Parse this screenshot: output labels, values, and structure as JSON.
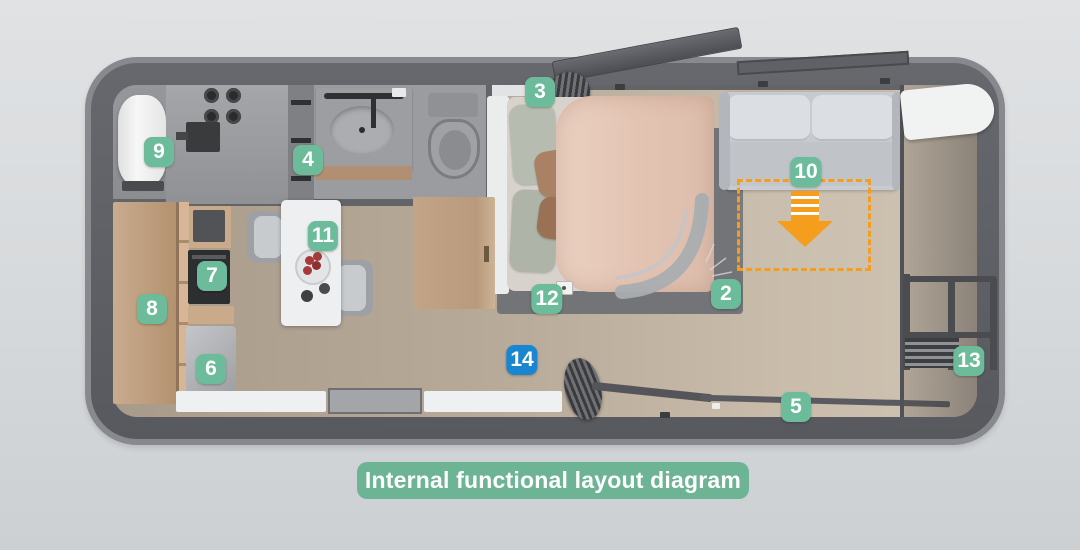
{
  "caption": {
    "text": "Internal functional layout diagram"
  },
  "colors": {
    "badge_green": "#6cbc9b",
    "badge_blue": "#1b86d0",
    "arrow_orange": "#f59d1d",
    "caption_bg": "#6db495",
    "caption_text": "#ffffff"
  },
  "badges": [
    {
      "label": "2",
      "x": 726,
      "y": 294,
      "color": "green"
    },
    {
      "label": "3",
      "x": 540,
      "y": 92,
      "color": "green"
    },
    {
      "label": "4",
      "x": 308,
      "y": 160,
      "color": "green"
    },
    {
      "label": "5",
      "x": 796,
      "y": 407,
      "color": "green"
    },
    {
      "label": "6",
      "x": 211,
      "y": 369,
      "color": "green"
    },
    {
      "label": "7",
      "x": 212,
      "y": 276,
      "color": "green"
    },
    {
      "label": "8",
      "x": 152,
      "y": 309,
      "color": "green"
    },
    {
      "label": "9",
      "x": 159,
      "y": 152,
      "color": "green"
    },
    {
      "label": "10",
      "x": 806,
      "y": 172,
      "color": "green"
    },
    {
      "label": "11",
      "x": 323,
      "y": 236,
      "color": "green"
    },
    {
      "label": "12",
      "x": 547,
      "y": 299,
      "color": "green"
    },
    {
      "label": "13",
      "x": 969,
      "y": 361,
      "color": "green"
    },
    {
      "label": "14",
      "x": 522,
      "y": 360,
      "color": "blue"
    }
  ]
}
